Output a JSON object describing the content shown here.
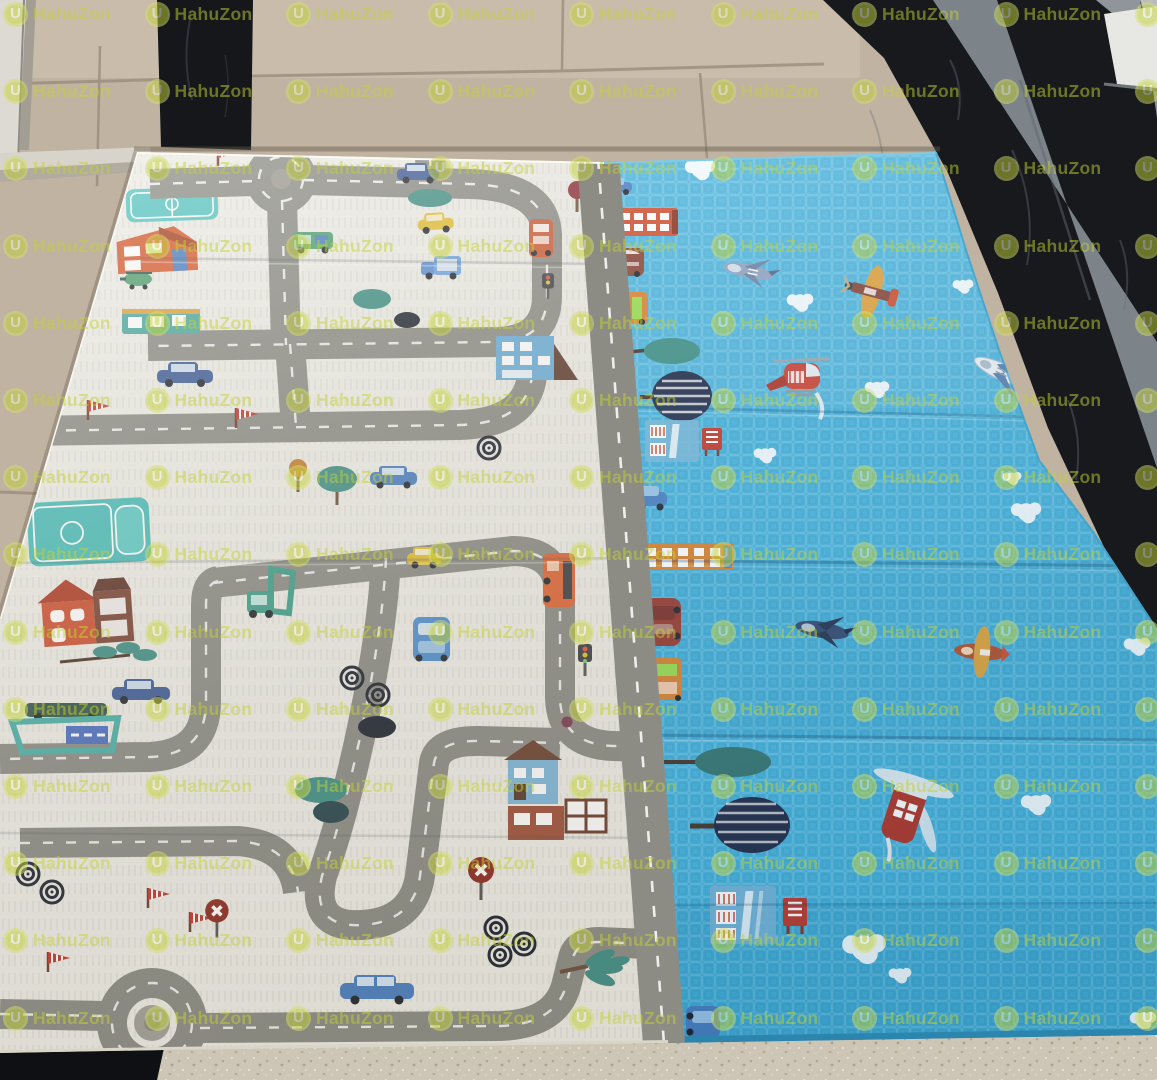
{
  "watermark": {
    "brand": "HahuZon",
    "logo_letter": "U",
    "color": "#c3d233",
    "opacity": 0.5,
    "grid": {
      "x0": 3,
      "y0": 2,
      "dx": 141.5,
      "dy": 77.2,
      "cols": 9,
      "rows": 14
    }
  },
  "scene": {
    "type": "product-photo",
    "subject": "foldable baby play mat photographed on a tiled floor beside black marble steps",
    "mat": {
      "left_panel_theme": "city road map",
      "right_panel_theme": "blue sky with aircraft",
      "left_panel_items": "roads with dashed centre lines, two roundabouts, cars, buses, trucks, houses, shops, teal play courts, trees, spiral bushes, pennant flags, stop signs, traffic lights",
      "right_panel_items": "airplanes, helicopters, clouds, buildings and bus stops along the centre road, round trees",
      "colors": {
        "white_panel": "#efeee7",
        "blue_panel": "#48b4dd",
        "road": "#8c8c85",
        "road_dash": "#ffffff"
      }
    },
    "floor": {
      "colors": {
        "tile_beige": "#c1b3a2",
        "tile_beige_light": "#c9bcab",
        "speckled_tile": "#cdc5b6",
        "marble_black": "#17191d",
        "concrete_gray": "#868c93",
        "door_frame_white": "#dcdad3",
        "sill_white": "#e7e7e3"
      }
    }
  }
}
